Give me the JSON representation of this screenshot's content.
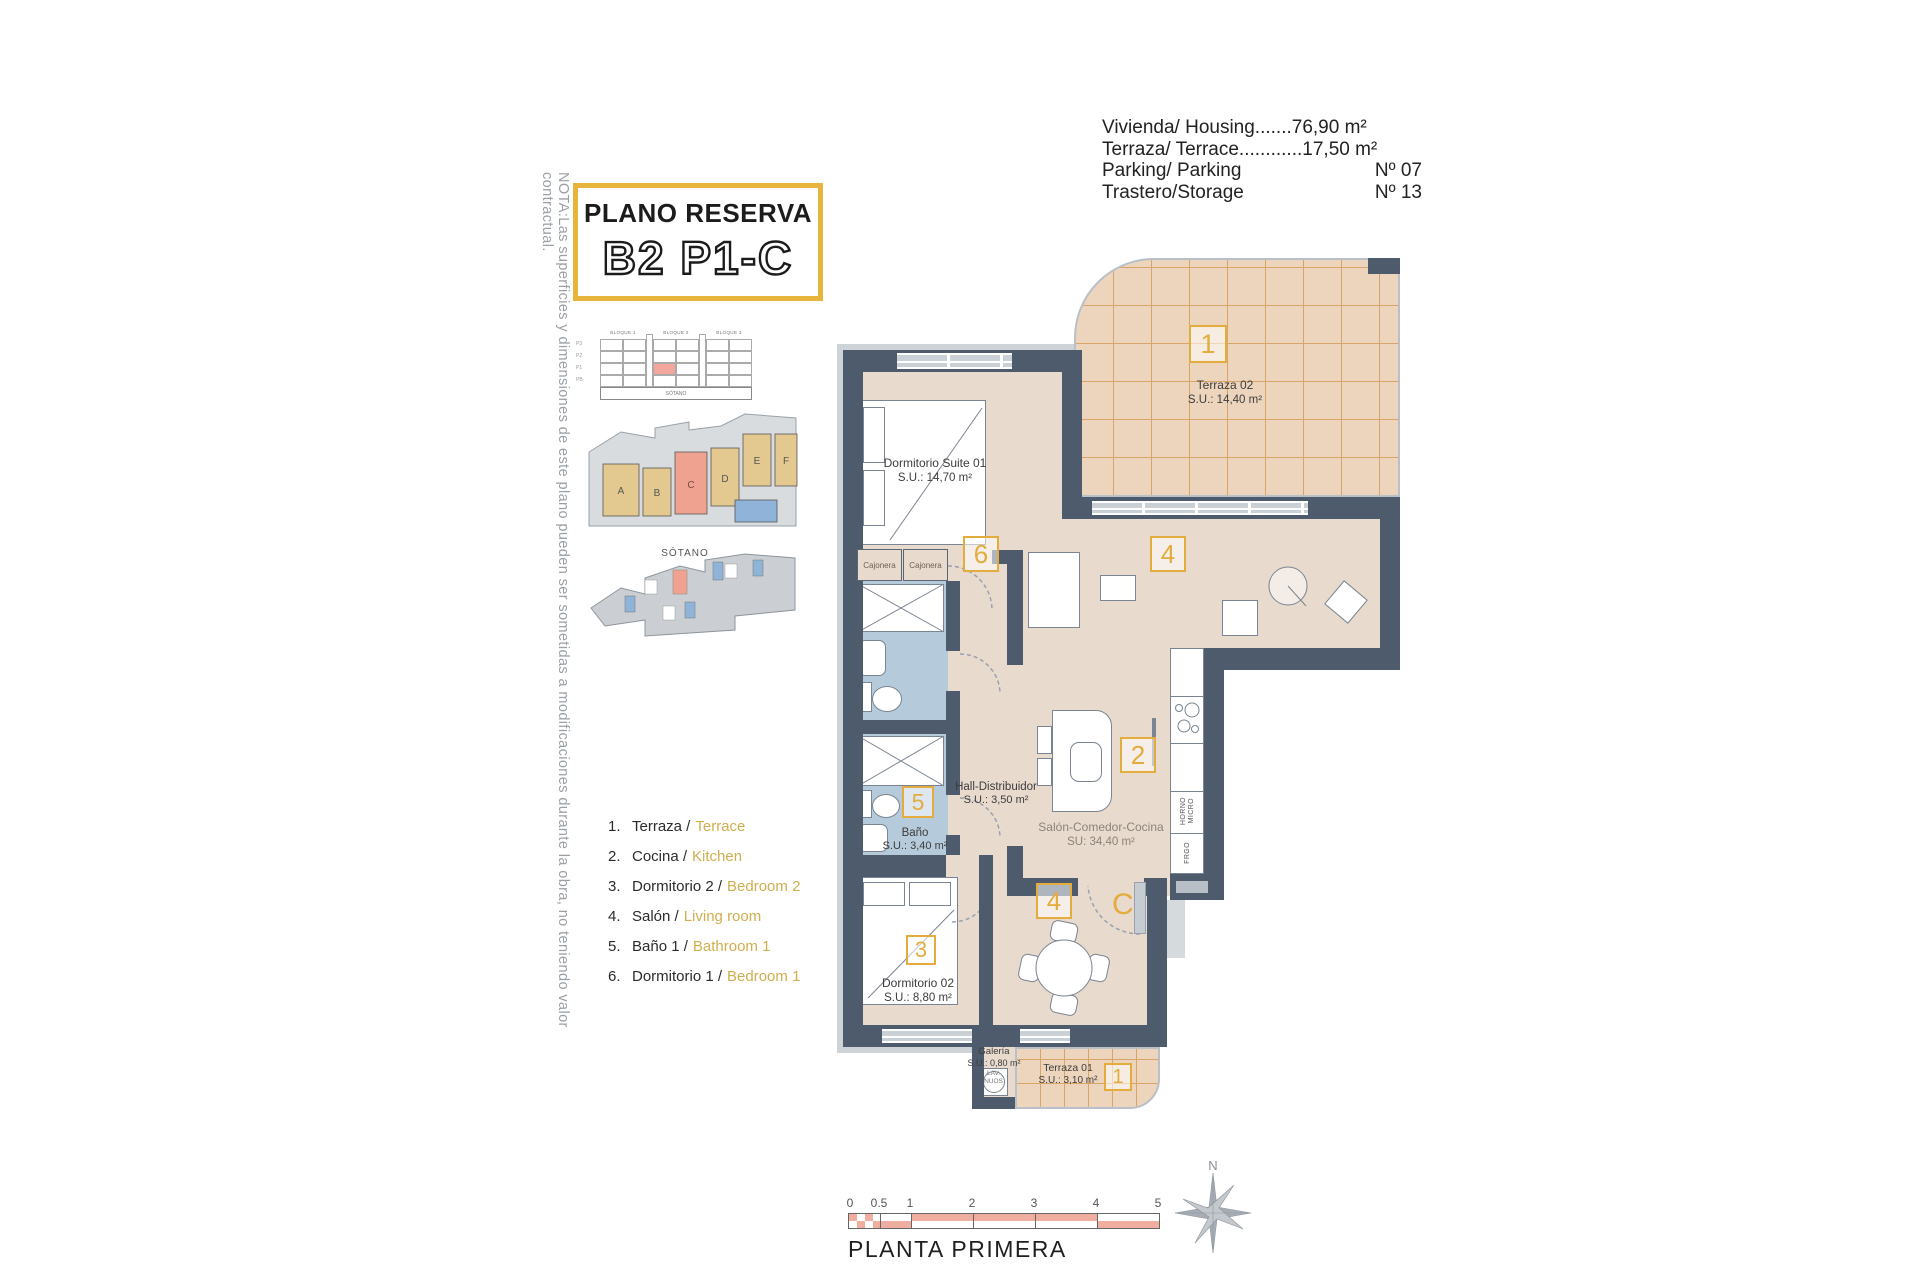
{
  "colors": {
    "accent_yellow": "#E3AC3C",
    "title_border": "#E7B43C",
    "wall": "#4D5B6C",
    "floor_beige": "#E9DACE",
    "terrace_tan": "#EDD5BD",
    "terrace_grid": "#D9A468",
    "bath_blue": "#B5CBDB",
    "highlight_red": "#F2A69E",
    "scale_pink": "#EFAE9F",
    "legend_en": "#CFAE4E",
    "diagram_gray": "#D8DCDF",
    "diagram_blue": "#8FB3D9"
  },
  "note": "NOTA:Las superficies y dimensiones de este plano pueden ser sometidas a modificaciones durante la obra, no teniendo valor contractual.",
  "title": {
    "line1": "PLANO RESERVA",
    "line2": "B2 P1-C"
  },
  "info": {
    "rows": [
      {
        "label": "Vivienda/ Housing.......",
        "value": "76,90 m²",
        "spread": false
      },
      {
        "label": "Terraza/ Terrace............",
        "value": "17,50 m²",
        "spread": false
      },
      {
        "label": "Parking/ Parking",
        "value": "Nº 07",
        "spread": true
      },
      {
        "label": "Trastero/Storage",
        "value": "Nº 13",
        "spread": true
      }
    ]
  },
  "diagram": {
    "bloques": [
      "BLOQUE 1",
      "BLOQUE 2",
      "BLOQUE 3"
    ],
    "floors": [
      "P3",
      "P2",
      "P1",
      "PB"
    ],
    "sotano": "SÓTANO",
    "sotano_label": "SÓTANO",
    "site_letters": [
      "A",
      "B",
      "C",
      "D",
      "E",
      "F"
    ]
  },
  "legend": {
    "items": [
      {
        "num": "1.",
        "es": "Terraza /",
        "en": "Terrace"
      },
      {
        "num": "2.",
        "es": "Cocina /",
        "en": "Kitchen"
      },
      {
        "num": "3.",
        "es": "Dormitorio 2 /",
        "en": "Bedroom 2"
      },
      {
        "num": "4.",
        "es": "Salón /",
        "en": "Living room"
      },
      {
        "num": "5.",
        "es": "Baño 1 /",
        "en": "Bathroom 1"
      },
      {
        "num": "6.",
        "es": "Dormitorio 1 /",
        "en": "Bedroom 1"
      }
    ]
  },
  "plan": {
    "rooms": {
      "suite": {
        "name": "Dormitorio Suite 01",
        "area": "S.U.: 14,70 m²"
      },
      "terraza02": {
        "name": "Terraza 02",
        "area": "S.U.: 14,40 m²"
      },
      "hall": {
        "name": "Hall-Distribuidor",
        "area": "S.U.: 3,50 m²"
      },
      "bano": {
        "name": "Baño",
        "area": "S.U.: 3,40 m²"
      },
      "salon": {
        "name": "Salón-Comedor-Cocina",
        "area": "SU: 34,40 m²"
      },
      "dorm02": {
        "name": "Dormitorio 02",
        "area": "S.U.: 8,80 m²"
      },
      "galeria": {
        "name": "Galería",
        "area": "S.U.: 0,80 m²"
      },
      "terraza01": {
        "name": "Terraza 01",
        "area": "S.U.: 3,10 m²"
      }
    },
    "markers": {
      "terraza02": "1",
      "suite": "6",
      "salon_top": "4",
      "kitchen": "2",
      "bano": "5",
      "dorm02": "3",
      "dining": "4",
      "terraza01": "1",
      "entry": "C"
    },
    "labels": {
      "cajonera": "Cajonera",
      "horno": "HORNO",
      "micro": "MICRO",
      "frigo": "FRGO",
      "lav1": "LAV.",
      "lav2": "NUOS"
    }
  },
  "scale": {
    "ticks": [
      "0",
      "0.5",
      "1",
      "2",
      "3",
      "4",
      "5"
    ],
    "caption": "PLANTA PRIMERA"
  },
  "compass_n": "N"
}
